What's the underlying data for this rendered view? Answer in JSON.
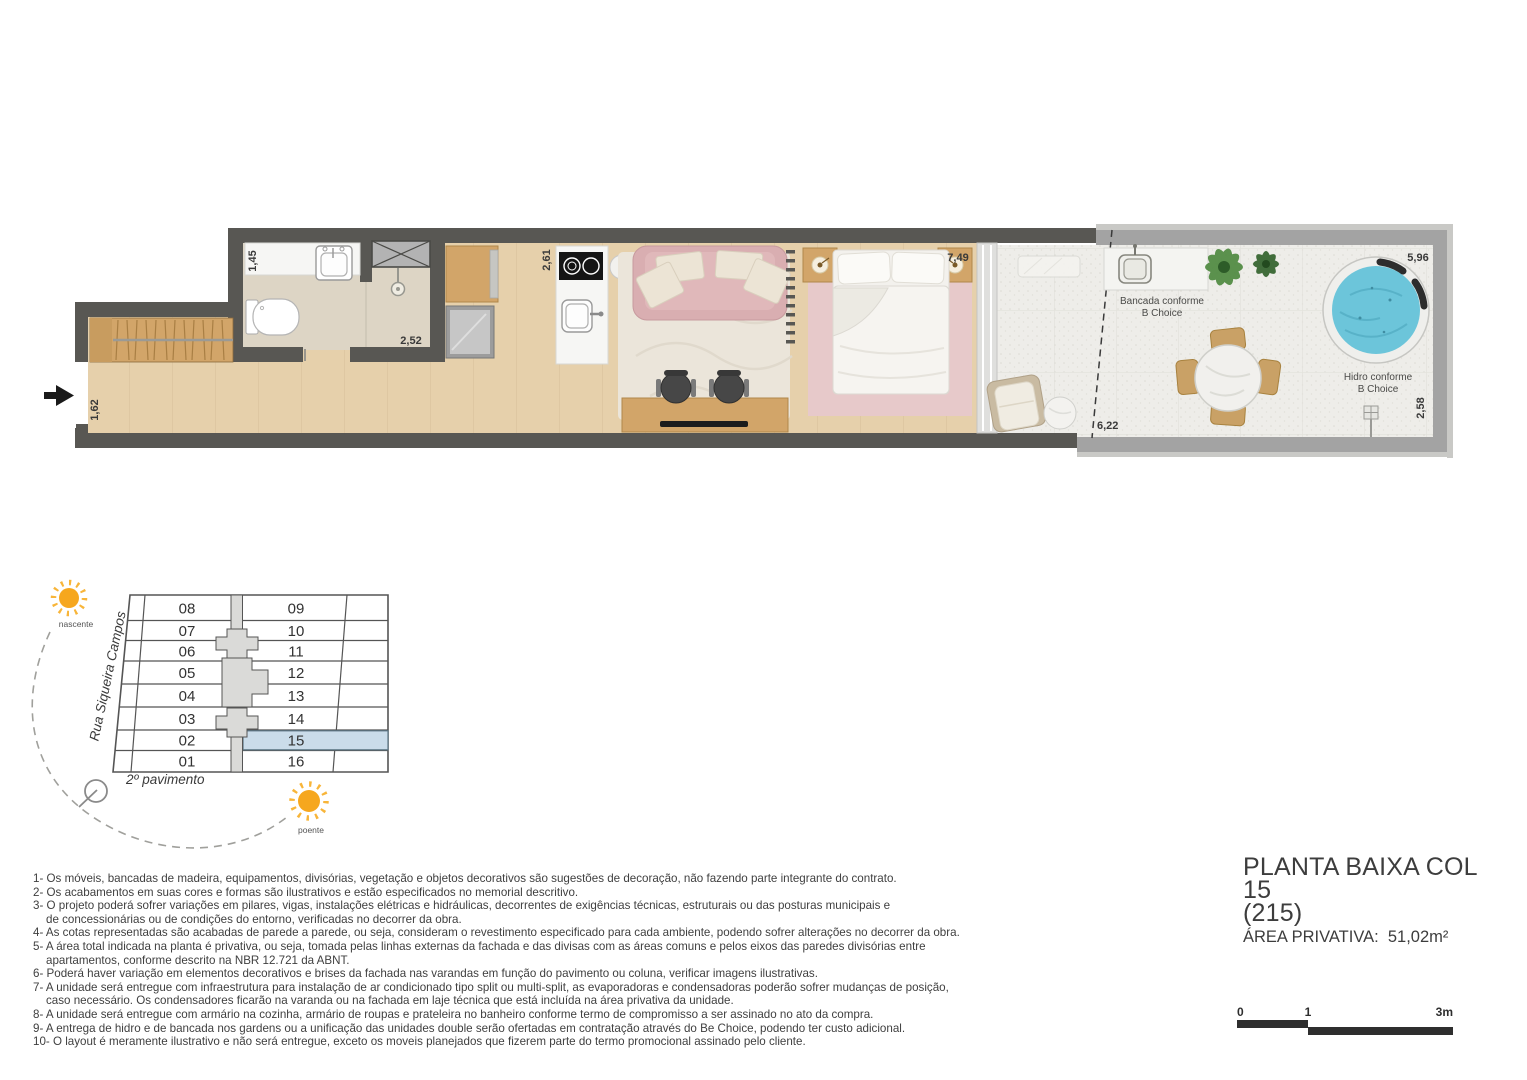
{
  "floor_plan": {
    "dimensions": {
      "entry": "1,62",
      "bathroom_width": "1,45",
      "bathroom_length": "2,52",
      "kitchen_width": "2,61",
      "living_length": "7,49",
      "terrace_length_left": "6,22",
      "terrace_length_right": "5,96",
      "terrace_width": "2,58"
    },
    "annotations": {
      "bancada_line1": "Bancada conforme",
      "bancada_line2": "B Choice",
      "hidro_line1": "Hidro conforme",
      "hidro_line2": "B Choice"
    },
    "icons": {
      "entrance_arrow": "solid-right-arrow",
      "shaft": "crossed-box-duct",
      "drain": "floor-drain-grid"
    }
  },
  "key_plan": {
    "left_units": [
      "08",
      "07",
      "06",
      "05",
      "04",
      "03",
      "02",
      "01"
    ],
    "right_units": [
      "09",
      "10",
      "11",
      "12",
      "13",
      "14",
      "15",
      "16"
    ],
    "highlighted_unit": "15",
    "street_label": "Rua Siqueira Campos",
    "floor_label": "2º pavimento",
    "sun_east_label": "nascente",
    "sun_west_label": "poente",
    "icons": {
      "sun_east": "sun",
      "sun_west": "sun",
      "north_indicator": "circle-with-needle"
    }
  },
  "notes": {
    "lines": [
      {
        "text": "1- Os móveis, bancadas de madeira, equipamentos, divisórias, vegetação e objetos decorativos são sugestões de decoração, não fazendo parte integrante do contrato.",
        "indent": false
      },
      {
        "text": "2- Os acabamentos em suas cores e formas são ilustrativos e estão especificados no memorial descritivo.",
        "indent": false
      },
      {
        "text": "3- O projeto poderá sofrer variações em pilares, vigas, instalações elétricas e hidráulicas, decorrentes de exigências técnicas, estruturais ou das posturas municipais e",
        "indent": false
      },
      {
        "text": "de concessionárias ou de condições do entorno, verificadas no decorrer da obra.",
        "indent": true
      },
      {
        "text": "4- As cotas representadas são acabadas de parede a parede, ou seja, consideram o revestimento especificado para cada ambiente, podendo sofrer alterações no decorrer da obra.",
        "indent": false
      },
      {
        "text": "5- A área total indicada na planta é privativa, ou seja, tomada pelas linhas externas da fachada e das divisas com as áreas comuns e pelos eixos das paredes divisórias entre",
        "indent": false
      },
      {
        "text": "apartamentos, conforme descrito na NBR 12.721 da ABNT.",
        "indent": true
      },
      {
        "text": "6- Poderá haver variação em elementos decorativos e brises da fachada nas varandas em função do pavimento ou coluna, verificar imagens ilustrativas.",
        "indent": false
      },
      {
        "text": "7- A unidade será entregue com infraestrutura para instalação de ar condicionado tipo split ou multi-split, as evaporadoras e condensadoras poderão sofrer mudanças de posição,",
        "indent": false
      },
      {
        "text": "caso necessário. Os condensadores ficarão na varanda ou na fachada em laje técnica que está incluída na área privativa da unidade.",
        "indent": true
      },
      {
        "text": "8- A unidade será entregue com armário na cozinha, armário de roupas e prateleira no banheiro conforme termo de compromisso a ser assinado no ato da compra.",
        "indent": false
      },
      {
        "text": "9- A entrega de hidro e de bancada nos gardens ou a unificação das unidades double serão ofertadas em contratação através do Be Choice, podendo ter custo adicional.",
        "indent": false
      },
      {
        "text": "10- O layout é meramente ilustrativo e não será entregue, exceto os moveis planejados que fizerem parte do termo promocional assinado pelo cliente.",
        "indent": false
      }
    ]
  },
  "title_block": {
    "title_line1": "PLANTA BAIXA COL 15",
    "title_line2": "(215)",
    "area_label": "ÁREA PRIVATIVA:  51,02m²"
  },
  "scale_bar": {
    "tick0": "0",
    "tick1": "1",
    "tick2": "3m"
  },
  "colors": {
    "wall_dark": "#585753",
    "wall_terrace": "#a3a3a3",
    "floor_wood": "#e6d0ab",
    "floor_bathroom": "#ddd5c5",
    "floor_terrace": "#eeede9",
    "furniture_wood": "#d2a569",
    "sofa_pink": "#d9aeb1",
    "bedroom_rug_pink": "#e7c9ca",
    "hydro_water": "#6cc5da",
    "unit_highlight": "#cadcea",
    "sun": "#f6a71e"
  }
}
